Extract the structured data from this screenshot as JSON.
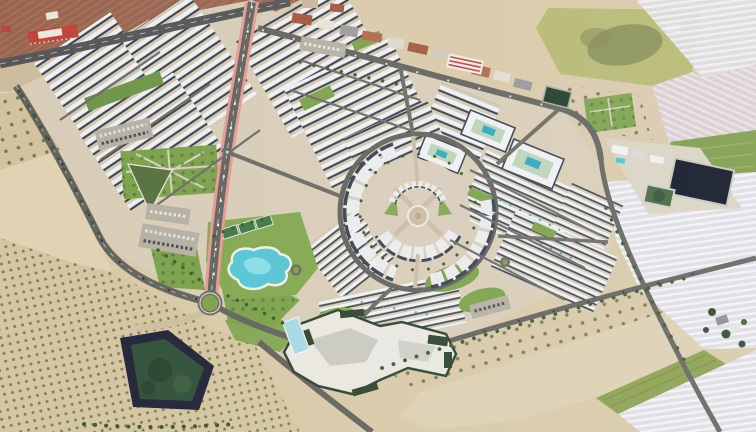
{
  "image": {
    "width": 756,
    "height": 432,
    "type": "aerial-photograph",
    "view": "oblique aerial, daytime",
    "subject": "Master-planned resort community with circular central plaza, surrounded by Mediterranean farmland"
  },
  "palette": {
    "terrain_tan": "#d8c9a8",
    "sand_lot": "#e0d2b2",
    "plowed_brown": "#99654f",
    "paving": "#d8cdb7",
    "plaza_paving": "#d9cdbb",
    "building_white": "#edeff1",
    "building_shadow": "#39424e",
    "road_gray": "#64645f",
    "highway_gray": "#57575a",
    "lane_pink": "#e59a92",
    "park_green": "#7ca24b",
    "lawn_bright": "#83a851",
    "tree_green": "#3c5a33",
    "lagoon_turquoise": "#57c5d5",
    "lagoon_light": "#8adde6",
    "pool_teal": "#2fa8bf",
    "pond_navy": "#0d1424",
    "pond_liner": "#23263a",
    "pond_algae": "#33523a",
    "pond_green_water": "#44663e",
    "village_pond": "#1f3b2a",
    "greenhouse_white": "#e3e3e8",
    "field_yellow_green": "#b5b871",
    "field_olive": "#838b55",
    "field_green": "#7e9c4a",
    "crop_green": "#8aa050",
    "village_terracotta": "#a2593e",
    "entrance_red": "#c24438",
    "lap_pool_blue": "#a8d8e4",
    "building_green_roof": "#2e452e",
    "parking_gray": "#b5b0a2"
  },
  "features": {
    "central_plaza": "circular plaza with horseshoe building arc and radial paths",
    "lagoon": "free-form lagoon swimming pool with white sand rim",
    "padel_courts": "three green sport courts beside lagoon",
    "main_avenue": "avenue with pink cycle lanes",
    "roundabout": "landscaped roundabout with green center",
    "resort_building": "large angular building with dark-green roof edging and lap pool",
    "courtyard_blocks": "apartment rings with shared teal pools",
    "villa_rows": "diagonal rows of white villas",
    "irrigation_pond_dark": "navy-lined irrigation pond",
    "irrigation_pond_green": "green-water irrigation pond",
    "sw_pond": "large dark-lined pond with algae-green water among orchards",
    "orchards": "dotted olive/citrus orchard rows",
    "greenhouse_fields": "pale striped greenhouse and plowed fields",
    "village": "existing village strip with terracotta roofs along highway",
    "farm": "farmstead with tree cluster in fields"
  }
}
